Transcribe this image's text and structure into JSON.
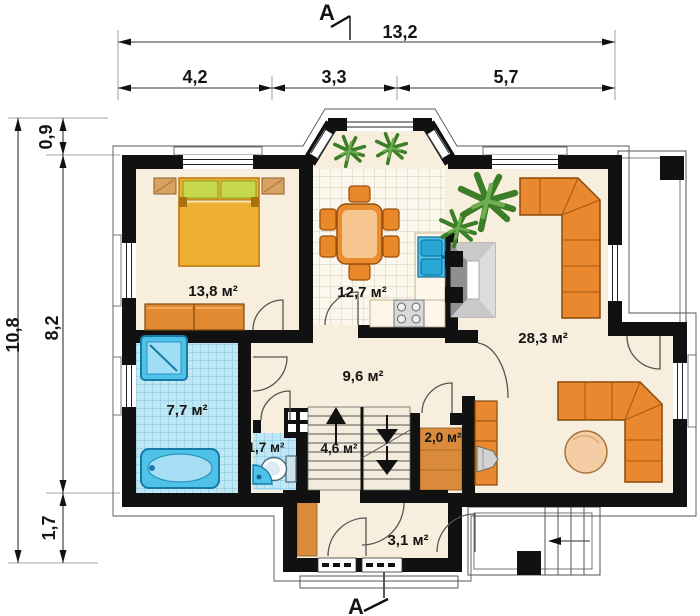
{
  "plan": {
    "section_label": "A",
    "dimensions": {
      "top": {
        "total": "13,2",
        "segments": [
          "4,2",
          "3,3",
          "5,7"
        ]
      },
      "left": {
        "total": "10,8",
        "segments": [
          "0,9",
          "8,2",
          "1,7"
        ]
      }
    },
    "rooms": [
      {
        "name": "bedroom",
        "area": "13,8 м²"
      },
      {
        "name": "kitchen-dining",
        "area": "12,7 м²"
      },
      {
        "name": "living-room",
        "area": "28,3 м²"
      },
      {
        "name": "hall",
        "area": "9,6 м²"
      },
      {
        "name": "bathroom",
        "area": "7,7 м²"
      },
      {
        "name": "wc",
        "area": "1,7 м²"
      },
      {
        "name": "staircase",
        "area": "4,6 м²"
      },
      {
        "name": "pantry",
        "area": "2,0 м²"
      },
      {
        "name": "vestibule",
        "area": "3,1 м²"
      }
    ],
    "colors": {
      "wall": "#111111",
      "floor_cream": "#f8eedd",
      "kitchen_tile": "#fdf8ee",
      "bath_tile": "#c2e7f4",
      "furniture_orange": "#e9882e",
      "bed_gold": "#edb033",
      "pillow_green": "#c5d84e",
      "fixture_blue": "#4fc2e8",
      "plant_green": "#3c7d27",
      "table_peach": "#f4cda4"
    }
  }
}
